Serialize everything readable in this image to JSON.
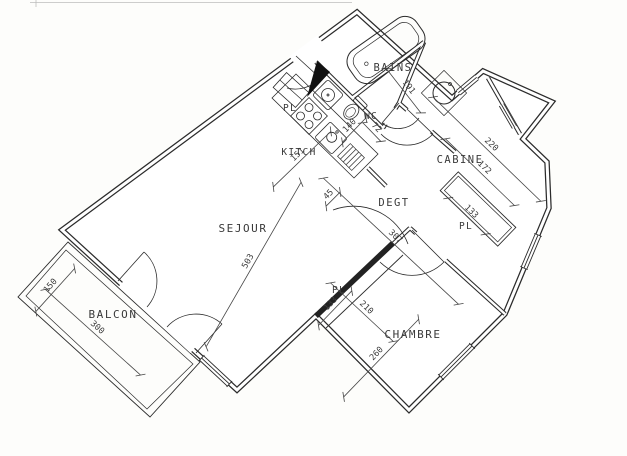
{
  "drawing": {
    "kind": "apartment floor plan",
    "colors": {
      "ink": "#2b2b2b",
      "paper": "#fdfdfb",
      "dim": "#454545"
    }
  },
  "rooms": [
    {
      "id": "sejour",
      "label": "SEJOUR",
      "x": 243,
      "y": 232,
      "fs": 11
    },
    {
      "id": "chambre",
      "label": "CHAMBRE",
      "x": 413,
      "y": 338,
      "fs": 11
    },
    {
      "id": "balcon",
      "label": "BALCON",
      "x": 113,
      "y": 318,
      "fs": 11
    },
    {
      "id": "cabine",
      "label": "CABINE",
      "x": 460,
      "y": 163,
      "fs": 10.5
    },
    {
      "id": "degt",
      "label": "DEGT",
      "x": 394,
      "y": 206,
      "fs": 10.5
    },
    {
      "id": "bains",
      "label": "BAINS",
      "x": 393,
      "y": 71,
      "fs": 10.5
    },
    {
      "id": "wc",
      "label": "WC",
      "x": 371,
      "y": 119,
      "fs": 9.5
    },
    {
      "id": "kitch",
      "label": "KITCH",
      "x": 299,
      "y": 155,
      "fs": 9.5
    },
    {
      "id": "pl-entry",
      "label": "PL",
      "x": 290,
      "y": 111,
      "fs": 9.5
    },
    {
      "id": "pl-cabine",
      "label": "PL",
      "x": 466,
      "y": 229,
      "fs": 9.5
    },
    {
      "id": "pl-chambre",
      "label": "PL",
      "x": 339,
      "y": 293,
      "fs": 9.5
    }
  ],
  "dimensions": [
    {
      "value": "503",
      "x": 251,
      "y": 263,
      "rot": -60,
      "len": 190
    },
    {
      "value": "151",
      "x": 300,
      "y": 157,
      "rot": -44,
      "len": 80
    },
    {
      "value": "45",
      "x": 331,
      "y": 197,
      "rot": -45,
      "len": 20
    },
    {
      "value": "191",
      "x": 406,
      "y": 89,
      "rot": 52,
      "len": 56
    },
    {
      "value": "140",
      "x": 352,
      "y": 128,
      "rot": -46,
      "len": 34
    },
    {
      "value": "72",
      "x": 374,
      "y": 130,
      "rot": 46,
      "len": 26
    },
    {
      "value": "220",
      "x": 489,
      "y": 147,
      "rot": 44,
      "len": 150
    },
    {
      "value": "172",
      "x": 482,
      "y": 170,
      "rot": 44,
      "len": 96
    },
    {
      "value": "133",
      "x": 469,
      "y": 214,
      "rot": 44,
      "len": 52
    },
    {
      "value": "307",
      "x": 393,
      "y": 239,
      "rot": 43,
      "len": 185
    },
    {
      "value": "210",
      "x": 364,
      "y": 310,
      "rot": 43,
      "len": 86
    },
    {
      "value": "260",
      "x": 379,
      "y": 356,
      "rot": -46,
      "len": 108
    },
    {
      "value": "133",
      "x": 333,
      "y": 306,
      "rot": -46,
      "len": 48
    },
    {
      "value": "150",
      "x": 53,
      "y": 288,
      "rot": -48,
      "len": 58
    },
    {
      "value": "300",
      "x": 95,
      "y": 330,
      "rot": 42,
      "len": 128
    }
  ]
}
